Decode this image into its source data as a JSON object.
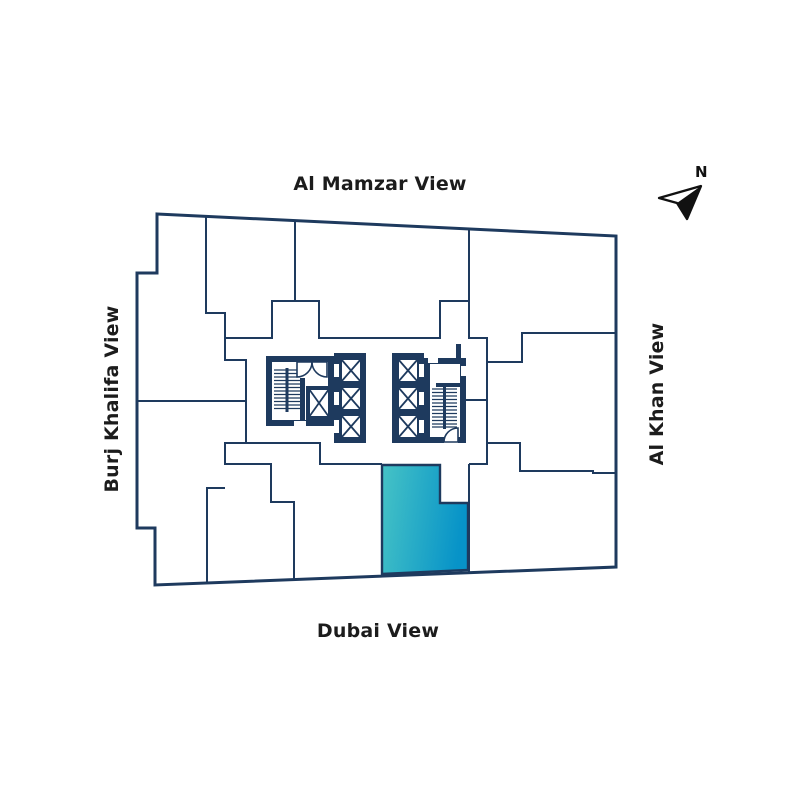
{
  "page": {
    "background_color": "#ffffff"
  },
  "floorplan": {
    "view_labels": {
      "top": "Al Mamzar View",
      "left": "Burj Khalifa View",
      "right": "Al Khan View",
      "bottom": "Dubai View"
    },
    "compass": {
      "label": "N"
    },
    "colors": {
      "wall": "#1e3a5e",
      "unit_fill": "#ffffff",
      "highlight_gradient_start": "#46c3c6",
      "highlight_gradient_end": "#0793c8",
      "label_text": "#1c1c1c",
      "compass": "#111111"
    },
    "highlighted_unit": {
      "position": "bottom-center",
      "style": "teal-gradient"
    }
  }
}
